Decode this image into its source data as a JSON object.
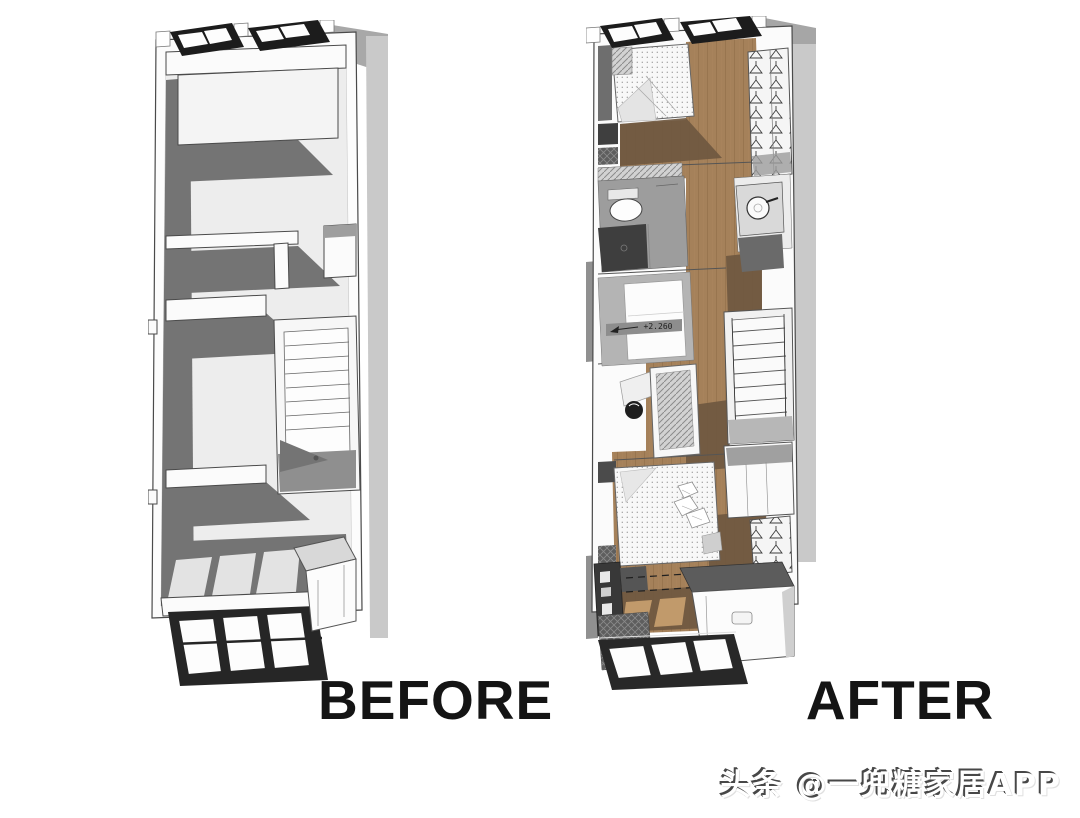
{
  "page": {
    "background_color": "#ffffff",
    "description": "Before/after axonometric floor plan comparison of a narrow loft apartment"
  },
  "figures": {
    "before": {
      "label": "BEFORE",
      "description": "Original empty floor plan, grayscale axonometric view with staircase and bare rooms"
    },
    "after": {
      "label": "AFTER",
      "description": "Renovated furnished floor plan with wood flooring, beds, bathroom, wardrobes, kitchen and stair",
      "level_annotation": "+2.260"
    }
  },
  "watermark": {
    "text": "头条 @一兜糖家居APP"
  },
  "colors": {
    "label_text": "#141414",
    "watermark_fill": "#ffffff",
    "watermark_shadow": "#474747",
    "wall_white": "#fbfbfb",
    "floor_light": "#ededed",
    "shadow_gray": "#747474",
    "exterior_gray": "#c9c9c9",
    "window_frame": "#262626",
    "wood_floor": "#a5815a",
    "wood_shadow": "#6f5840",
    "bath_floor": "#9d9d9d",
    "tile_dark": "#3e3e3e"
  }
}
